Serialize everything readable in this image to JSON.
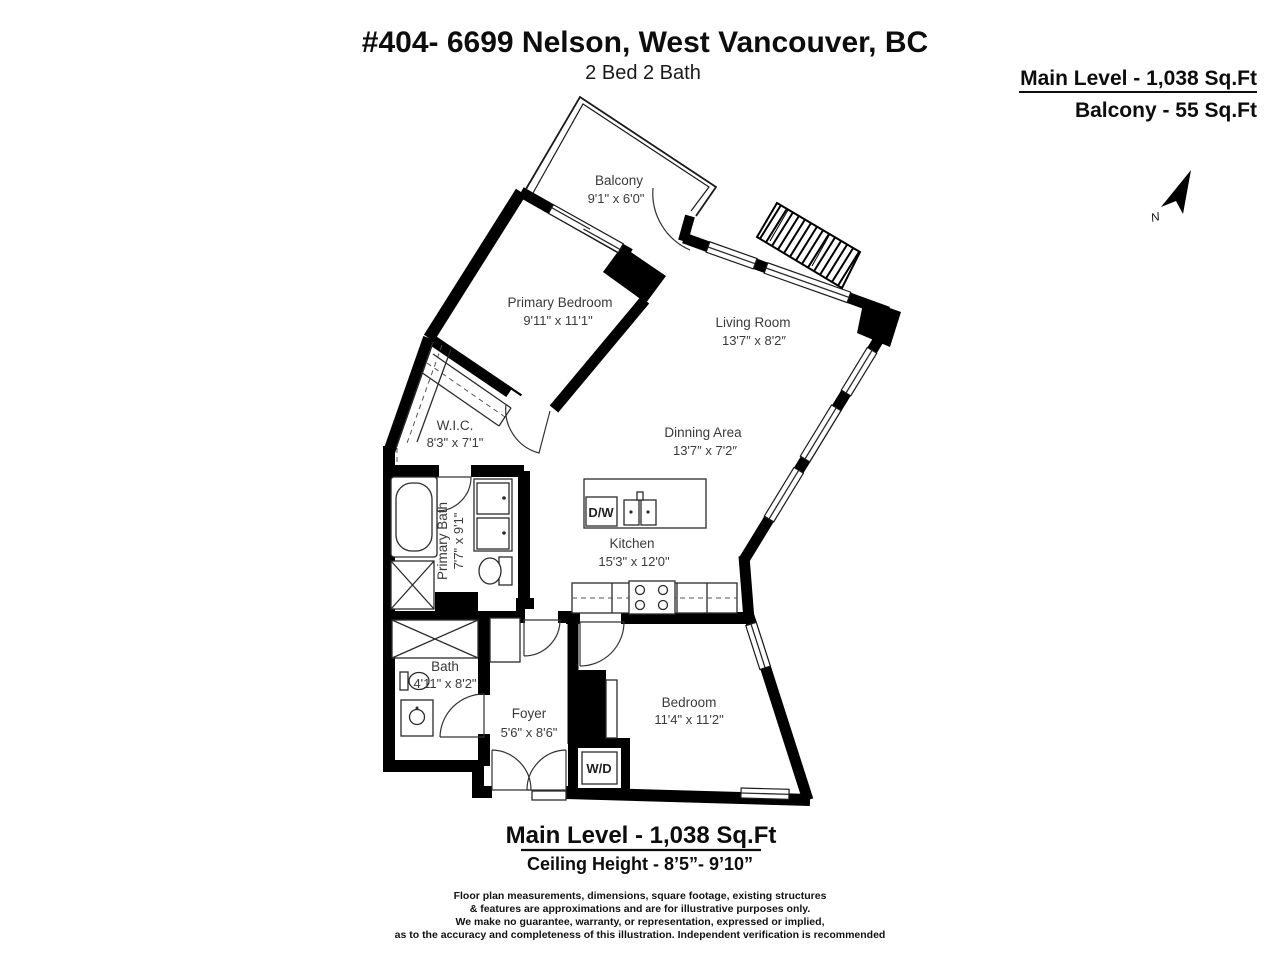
{
  "header": {
    "title": "#404- 6699 Nelson, West Vancouver, BC",
    "subtitle": "2 Bed 2 Bath"
  },
  "area_summary": {
    "main_level": "Main Level - 1,038 Sq.Ft",
    "balcony": "Balcony - 55 Sq.Ft"
  },
  "compass": {
    "label": "N"
  },
  "rooms": [
    {
      "name": "Balcony",
      "dims": "9'1\" x 6'0\""
    },
    {
      "name": "Primary Bedroom",
      "dims": "9'11\" x 11'1\""
    },
    {
      "name": "Living Room",
      "dims": "13'7″ x 8'2″"
    },
    {
      "name": "Dinning Area",
      "dims": "13'7″ x 7'2″"
    },
    {
      "name": "W.I.C.",
      "dims": "8'3\" x 7'1\""
    },
    {
      "name": "Primary Bath",
      "dims": "7'7\" x 9'1\""
    },
    {
      "name": "Kitchen",
      "dims": "15'3\" x 12'0\""
    },
    {
      "name": "Bath",
      "dims": "4'11\" x 8'2\""
    },
    {
      "name": "Foyer",
      "dims": "5'6\" x 8'6\""
    },
    {
      "name": "Bedroom",
      "dims": "11'4\" x 11'2\""
    }
  ],
  "appliances": {
    "dishwasher": "D/W",
    "washer_dryer": "W/D"
  },
  "footer": {
    "main_level": "Main Level - 1,038 Sq.Ft",
    "ceiling": "Ceiling Height - 8’5”- 9’10”",
    "disclaimer_lines": [
      "Floor plan measurements, dimensions, square footage, existing structures",
      "& features are approximations and are for illustrative purposes only.",
      "We make no guarantee, warranty, or representation, expressed or implied,",
      "as to the accuracy and completeness of this illustration. Independent verification is recommended"
    ]
  },
  "colors": {
    "wall": "#000000",
    "label": "#3a3a3a",
    "background": "#ffffff"
  }
}
